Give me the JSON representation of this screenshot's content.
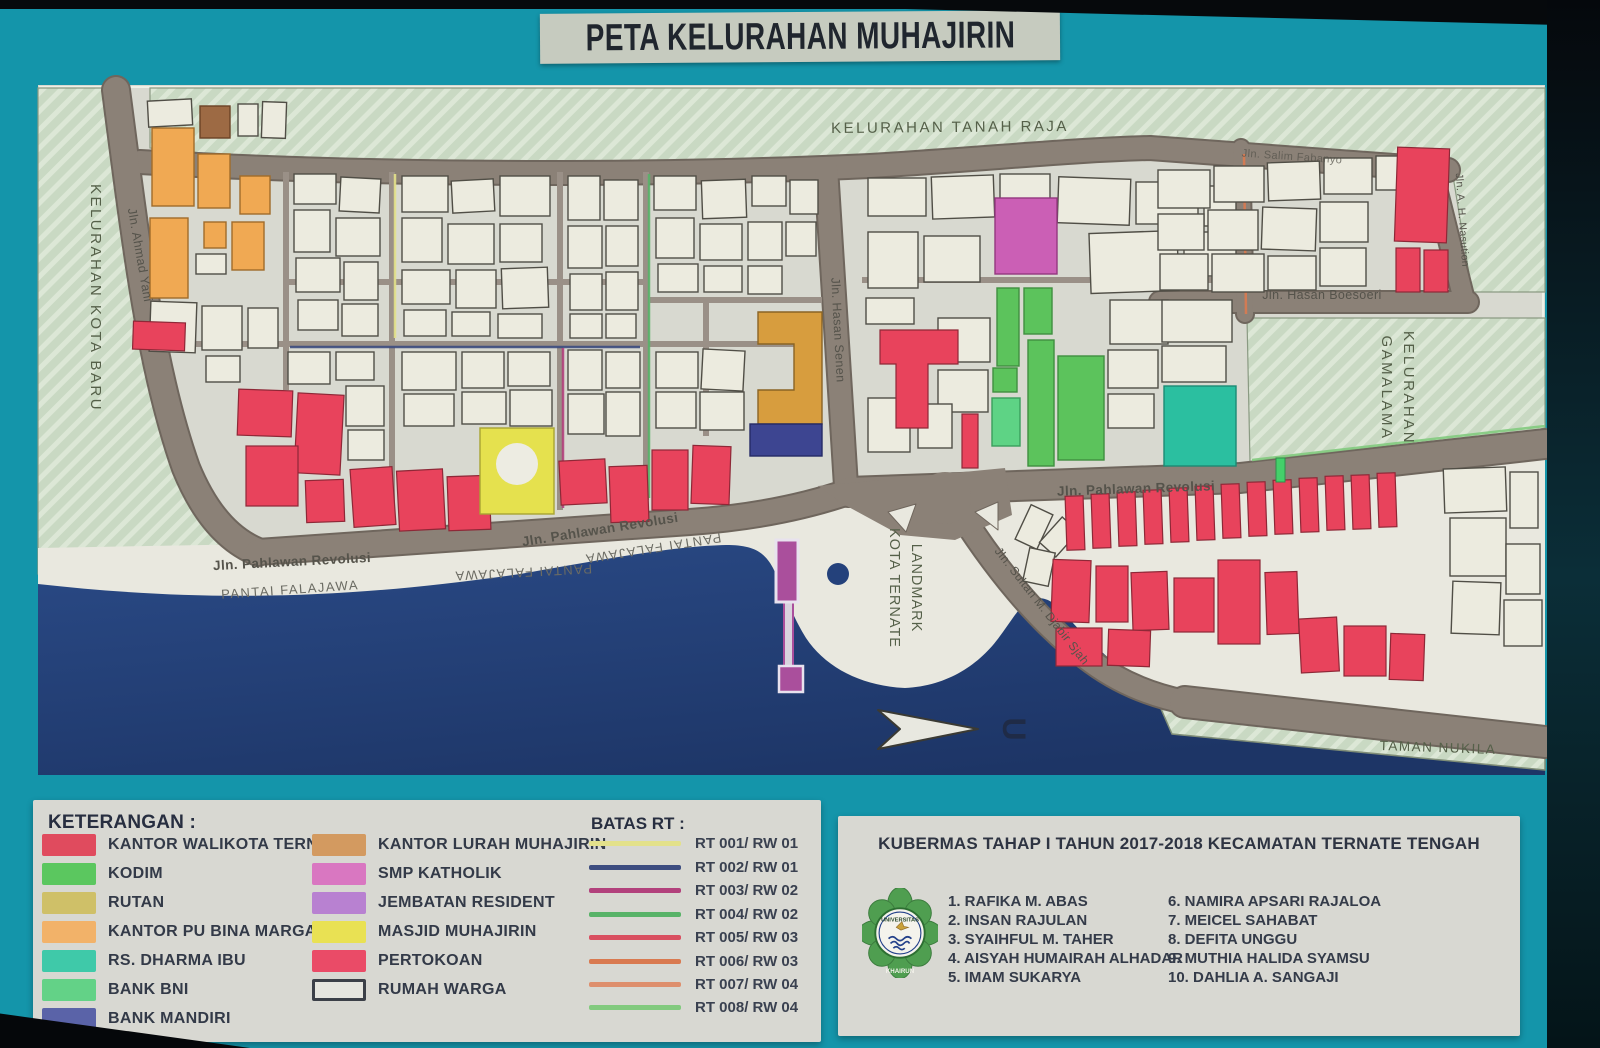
{
  "title": "PETA KELURAHAN MUHAJIRIN",
  "map": {
    "regions": {
      "tanah_raja": "KELURAHAN TANAH RAJA",
      "kota_baru": "KELURAHAN KOTA BARU",
      "gamalama_line1": "KELURAHAN",
      "gamalama_line2": "GAMALAMA",
      "taman_nukila": "TAMAN NUKILA",
      "landmark_line1": "LANDMARK",
      "landmark_line2": "KOTA TERNATE"
    },
    "streets": {
      "ahmad_yani": "Jln. Ahmad Yani",
      "hasan_senen": "Jln. Hasan Senen",
      "pahlawan_revolusi": "Jln. Pahlawan Revolusi",
      "pantai_falajawa": "PANTAI FALAJAWA",
      "salim_fabanyo": "Jln. Salim Fabanyo",
      "ah_nasution": "Jln. A. H. Nasution",
      "hasan_boesoeri": "Jln. Hasan Boesoeri",
      "sultan_djabir_sjah": "Jln. Sultan M. Djabir Sjah"
    },
    "compass_letter": "U"
  },
  "legend": {
    "title": "KETERANGAN :",
    "column1": [
      {
        "label": "KANTOR WALIKOTA TERNATE",
        "color": "#e04b5e"
      },
      {
        "label": "KODIM",
        "color": "#5bc75f"
      },
      {
        "label": "RUTAN",
        "color": "#cfc068"
      },
      {
        "label": "KANTOR PU BINA MARGA",
        "color": "#f2b269"
      },
      {
        "label": "RS. DHARMA IBU",
        "color": "#3fc9a9"
      },
      {
        "label": "BANK BNI",
        "color": "#63d287"
      },
      {
        "label": "BANK MANDIRI",
        "color": "#5a63a8"
      }
    ],
    "column2": [
      {
        "label": "KANTOR LURAH MUHAJIRIN",
        "color": "#d39a60"
      },
      {
        "label": "SMP KATHOLIK",
        "color": "#d977c1"
      },
      {
        "label": "JEMBATAN RESIDENT",
        "color": "#b881d1"
      },
      {
        "label": "MASJID MUHAJIRIN",
        "color": "#e9e153"
      },
      {
        "label": "PERTOKOAN",
        "color": "#ea4b67"
      },
      {
        "label": "RUMAH WARGA",
        "color": "#e6e6df"
      }
    ]
  },
  "batas_rt": {
    "title": "BATAS RT :",
    "entries": [
      {
        "label": "RT 001/ RW 01",
        "color": "#e3e18a"
      },
      {
        "label": "RT 002/ RW 01",
        "color": "#3d4d80"
      },
      {
        "label": "RT 003/ RW 02",
        "color": "#b2417c"
      },
      {
        "label": "RT 004/ RW 02",
        "color": "#58b368"
      },
      {
        "label": "RT 005/ RW 03",
        "color": "#d94f60"
      },
      {
        "label": "RT 006/ RW 03",
        "color": "#d97a50"
      },
      {
        "label": "RT 007/ RW 04",
        "color": "#de8f6d"
      },
      {
        "label": "RT 008/ RW 04",
        "color": "#82ca7e"
      }
    ]
  },
  "info_panel": {
    "title": "KUBERMAS TAHAP I TAHUN 2017-2018 KECAMATAN TERNATE TENGAH",
    "logo": {
      "name": "universitas-khairun-logo",
      "top_text": "UNIVERSITAS",
      "bottom_text": "KHAIRUN"
    },
    "participants_col1": [
      "1. RAFIKA M. ABAS",
      "2. INSAN RAJULAN",
      "3. SYAIHFUL M. TAHER",
      "4. AISYAH HUMAIRAH ALHADAR",
      "5. IMAM SUKARYA"
    ],
    "participants_col2": [
      "6. NAMIRA APSARI RAJALOA",
      "7. MEICEL SAHABAT",
      "8. DEFITA UNGGU",
      "9. MUTHIA HALIDA SYAMSU",
      "10. DAHLIA A. SANGAJI"
    ]
  },
  "palette": {
    "frame_teal": "#1495aa",
    "sea_blue": "#24417b",
    "land": "#d8d9d0",
    "beach": "#e9e8df",
    "road_gray": "#8b8177",
    "hatch_green": "#c9d9c3",
    "building_white": "#ecebdf",
    "walikota_red": "#e2445c",
    "kodim_green": "#5cc35c",
    "rutan_gold": "#d79d3e",
    "pu_orange": "#f0a953",
    "rs_teal": "#2bbfa0",
    "bni_green": "#5ed385",
    "mandiri_navy": "#3d4591",
    "lurah_brown": "#9d6a44",
    "smp_pink": "#cb5fb5",
    "resident_purple": "#aa4f9c",
    "masjid_yellow": "#e5e14e"
  }
}
